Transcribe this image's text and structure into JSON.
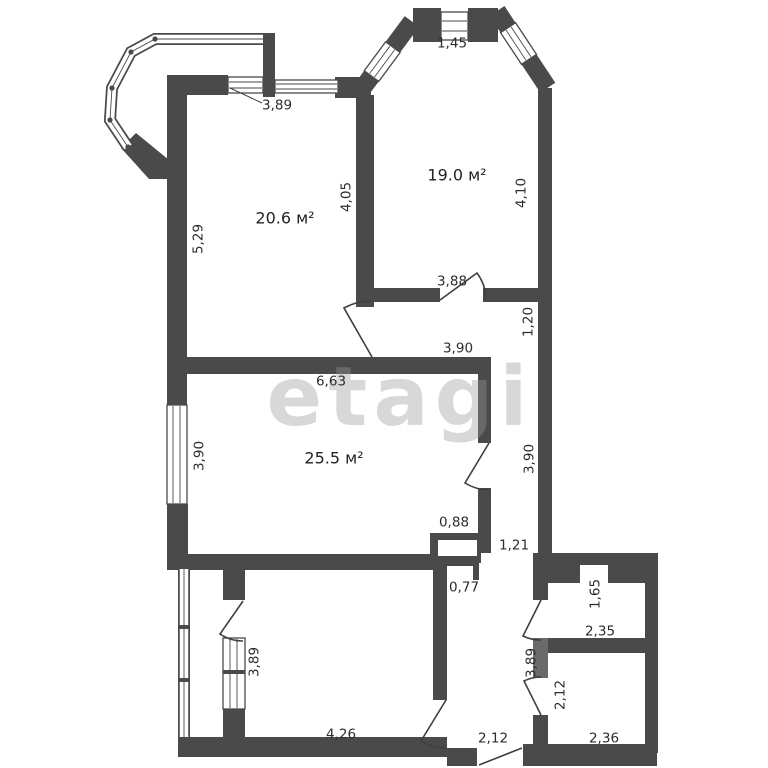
{
  "watermark": "etagi",
  "colors": {
    "walls": "#4a4a4a",
    "text": "#2d2d2d",
    "watermark": "#9a9a9a"
  },
  "rooms": {
    "room20": {
      "label": "20.6 м²"
    },
    "room19": {
      "label": "19.0 м²"
    },
    "room25": {
      "label": "25.5 м²"
    }
  },
  "dims": {
    "bay_top": "1,45",
    "room20_width": "3,89",
    "room20_height": "5,29",
    "room20_right": "4,05",
    "room19_right": "4,10",
    "room19_width": "3,88",
    "corridor_height": "1,20",
    "corridor_width": "3,90",
    "room25_width": "6,63",
    "room25_height": "3,90",
    "strip_length": "3,90",
    "shaft_width": "0,88",
    "strip_width": "1,21",
    "niche_width": "0,77",
    "bath_height": "1,65",
    "bath_width": "2,35",
    "hall_length": "3,89",
    "room_br_height": "2,12",
    "hall_width": "2,12",
    "room_bl_height": "3,89",
    "room_bl_width": "4,26",
    "room_br_width": "2,36"
  }
}
